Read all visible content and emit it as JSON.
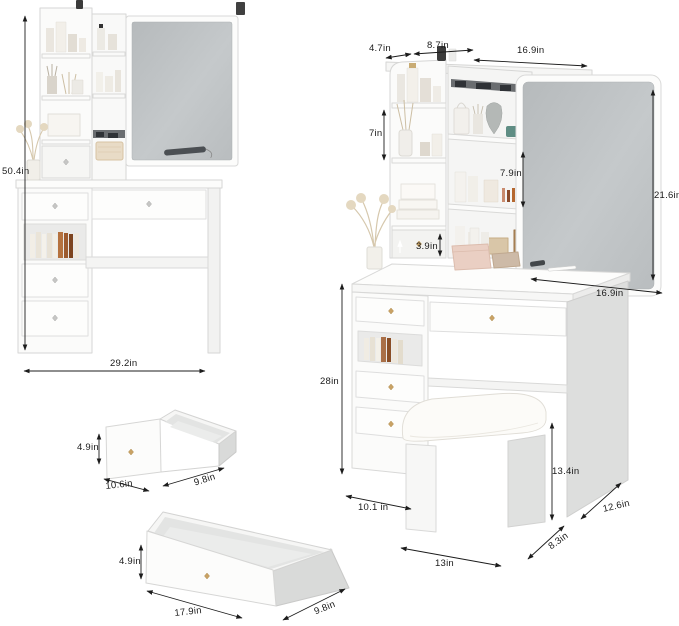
{
  "page": {
    "background": "#ffffff"
  },
  "palette": {
    "outline": "#d6d6d5",
    "dimension_line": "#1c1c1c",
    "mirror_glass": "#bcc0c2",
    "knob_gold": "#c9a265",
    "knob_silver": "#c6c6c5",
    "book_wood": "#a96f47",
    "basket": "#e8dbc6",
    "cushion": "#fcfbf8"
  },
  "figures": {
    "left_vanity": {
      "label": "vanity front view",
      "overall_height": "50.4in",
      "overall_width": "29.2in"
    },
    "right_vanity": {
      "label": "vanity perspective view with stool",
      "top_side_depth": "4.7in",
      "hutch_top_width": "8.7in",
      "mirror_slide_width": "16.9in",
      "open_shelf_height": "7in",
      "middle_shelf_height": "7.9in",
      "hutch_drawer_height": "3.9in",
      "mirror_height": "21.6in",
      "desktop_width": "16.9in",
      "desk_height": "28in",
      "base_depth": "10.1 in",
      "stool_height": "13.4in",
      "stool_depth": "8.3in",
      "desk_depth": "12.6in",
      "stool_width": "13in"
    },
    "small_drawer": {
      "label": "small drawer detail",
      "height": "4.9in",
      "width": "10.6in",
      "depth": "9.8in"
    },
    "large_drawer": {
      "label": "large drawer detail",
      "height": "4.9in",
      "width": "17.9in",
      "depth": "9.8in"
    }
  }
}
